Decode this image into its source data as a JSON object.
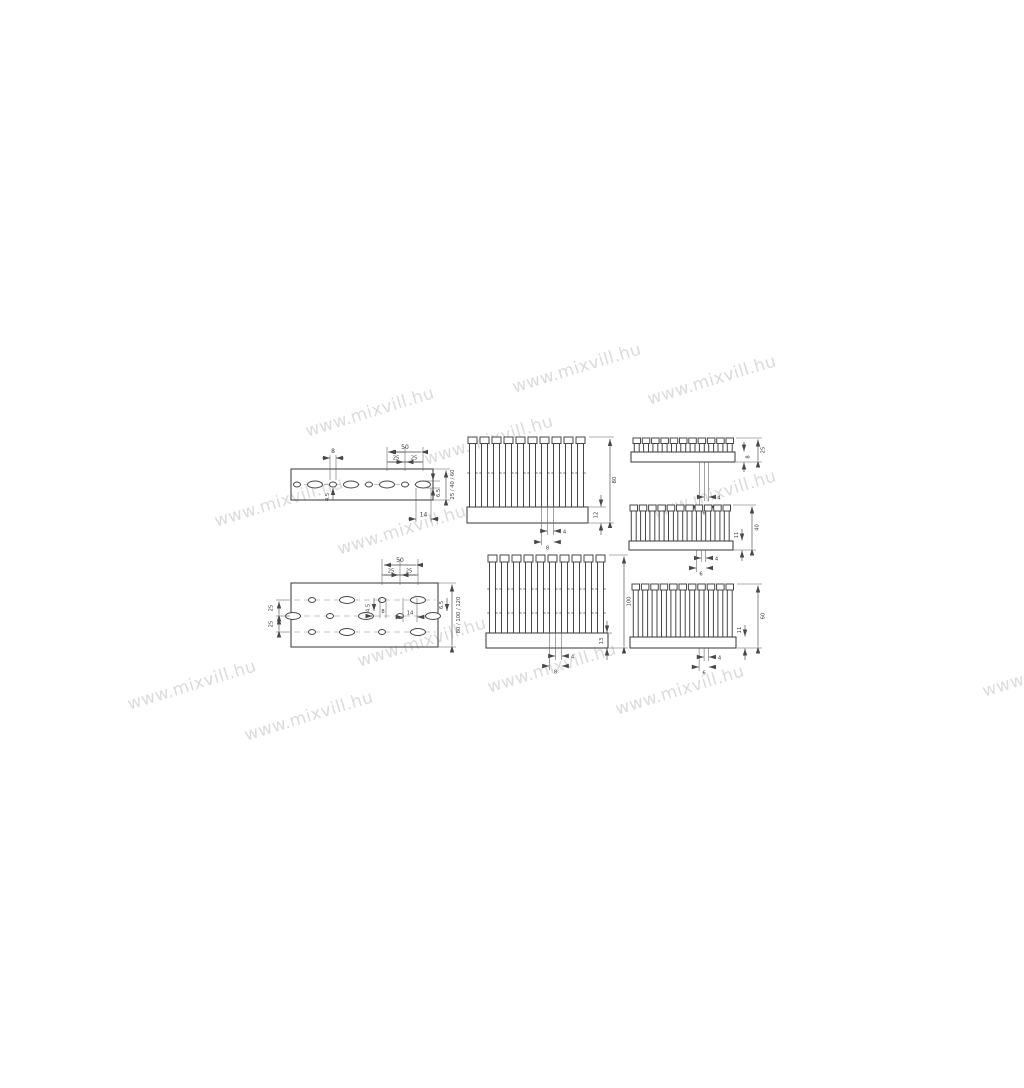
{
  "page": {
    "background": "#ffffff",
    "line_color": "#474747",
    "watermark_color": "#c8c8c8"
  },
  "watermark": {
    "text": "www.mixvill.hu"
  },
  "diagrams": {
    "strip": {
      "hole_width": "8",
      "pitch": "50",
      "pitch_half_a": "25",
      "pitch_half_b": "25",
      "hole_height": "4.5",
      "slot_height": "6.5",
      "slot_length": "14",
      "duct_widths": "25 / 40 / 60"
    },
    "comb80": {
      "height": "80",
      "base_height": "12",
      "slot_width": "4",
      "slot_pitch": "8"
    },
    "comb25": {
      "height": "25",
      "base_height": "8",
      "slot_width": "4",
      "slot_pitch": "6"
    },
    "comb40": {
      "height": "40",
      "base_height": "11",
      "slot_width": "4",
      "slot_pitch": "6"
    },
    "plate": {
      "pitch": "50",
      "pitch_half_a": "25",
      "pitch_half_b": "25",
      "row_spacing_a": "25",
      "row_spacing_b": "25",
      "hole_height": "4.5",
      "hole_spacing": "8",
      "slot_length": "14",
      "slot_height": "6.5",
      "duct_widths": "80 / 100 / 120"
    },
    "comb100": {
      "height": "100",
      "base_height": "13",
      "slot_width": "4",
      "slot_pitch": "8"
    },
    "comb60": {
      "height": "60",
      "base_height": "11",
      "slot_width": "4",
      "slot_pitch": "6"
    }
  }
}
